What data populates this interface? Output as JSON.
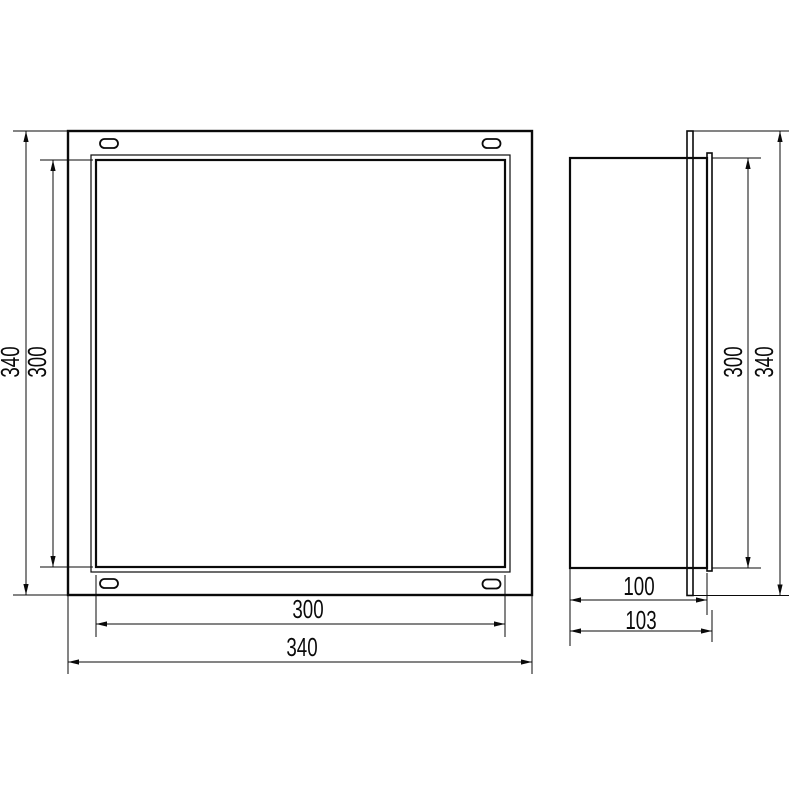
{
  "drawing": {
    "colors": {
      "line": "#0a0a0a",
      "background": "#ffffff"
    },
    "front_view": {
      "dim_outer_height": "340",
      "dim_opening_height": "300",
      "dim_opening_width": "300",
      "dim_outer_width": "340"
    },
    "side_view": {
      "dim_opening_height": "300",
      "dim_outer_height": "340",
      "dim_depth": "100",
      "dim_total_depth": "103"
    }
  }
}
